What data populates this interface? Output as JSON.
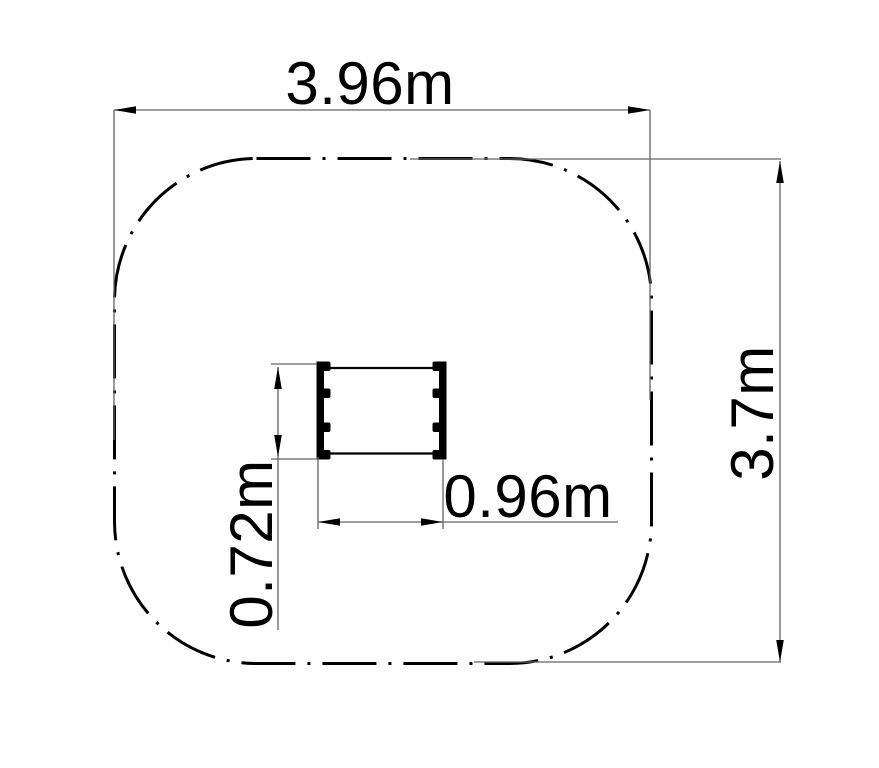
{
  "drawing": {
    "type": "plan-view-dimension-drawing",
    "labels": {
      "zone_width": "3.96m",
      "zone_height": "3.7m",
      "item_width": "0.96m",
      "item_height": "0.72m"
    },
    "colors": {
      "ink": "#000000",
      "dim_line": "#636363",
      "background": "#ffffff"
    }
  }
}
